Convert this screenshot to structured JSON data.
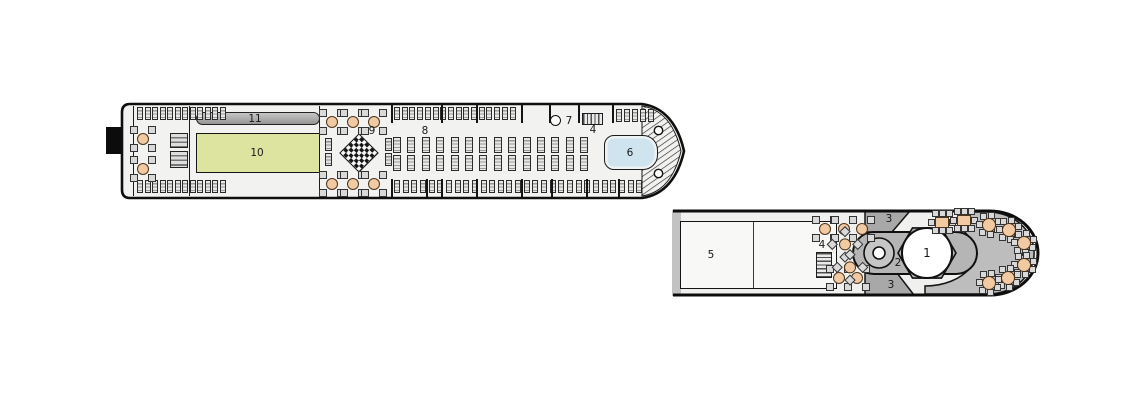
{
  "plan_title": "ship deck plan",
  "labels": {
    "u11": "11",
    "u10": "10",
    "u9": "9",
    "u8": "8",
    "u7": "7",
    "u4": "4",
    "u6": "6",
    "d5": "5",
    "d4": "4",
    "d3a": "3",
    "d3b": "3",
    "d2": "2",
    "d1": "1"
  },
  "colors": {
    "pool": "#cfe4ee",
    "green_area": "#dce49f",
    "track": "#a6a6a6",
    "terrace": "#bdbdbd",
    "bar_island": "#b5b5b5",
    "ramp": "#a8a8a8",
    "deck": "#f1f1ef",
    "outline": "#101010",
    "table_seat": "#f1c9a3"
  },
  "icons": {
    "chess_board": "checkerboard-diamond",
    "stairs": "striped-steps",
    "lounger": "striped-sunlounger",
    "table": "table-with-chairs"
  }
}
